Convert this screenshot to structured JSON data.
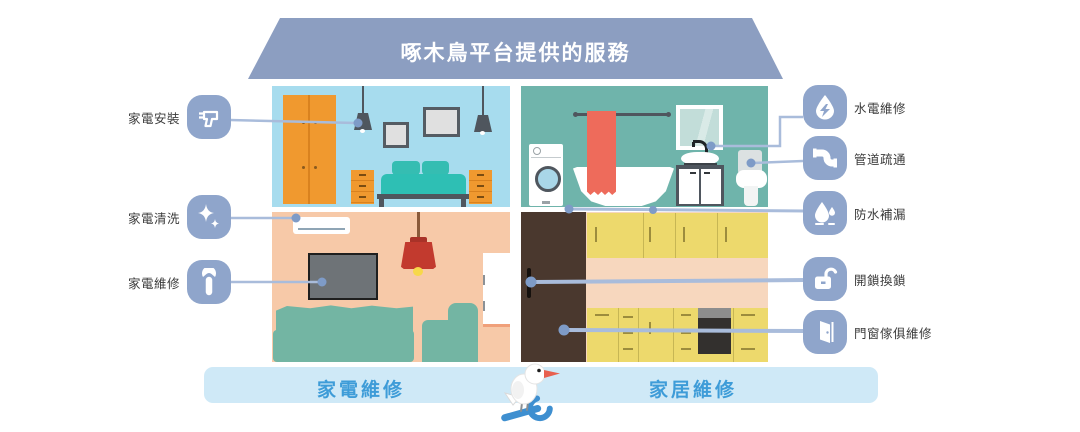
{
  "title": "啄木鳥平台提供的服務",
  "left_services": [
    {
      "label": "家電安裝",
      "icon": "drill-icon"
    },
    {
      "label": "家電清洗",
      "icon": "sparkle-clean-icon"
    },
    {
      "label": "家電維修",
      "icon": "wrench-icon"
    }
  ],
  "right_services": [
    {
      "label": "水電維修",
      "icon": "waterdrop-bolt-icon"
    },
    {
      "label": "管道疏通",
      "icon": "pipe-icon"
    },
    {
      "label": "防水補漏",
      "icon": "waterproof-drops-icon"
    },
    {
      "label": "開鎖換鎖",
      "icon": "open-lock-icon"
    },
    {
      "label": "門窗傢俱維修",
      "icon": "door-icon"
    }
  ],
  "bottom_bar": {
    "left_label": "家電維修",
    "right_label": "家居維修",
    "mascot": "woodpecker-with-wrench"
  },
  "colors": {
    "roof": "#8C9EC1",
    "icon_blue": "#8FA5CB",
    "connector_line": "#A9BCDB",
    "connector_dot": "#7E9BC7",
    "bar_background": "#CFE9F7",
    "bar_text": "#3E9CD8",
    "bedroom_wall": "#A7DCEE",
    "bathroom_wall": "#6FB4AB",
    "living_wall": "#F7C9A8",
    "kitchen_cabinet": "#EDD96C"
  }
}
